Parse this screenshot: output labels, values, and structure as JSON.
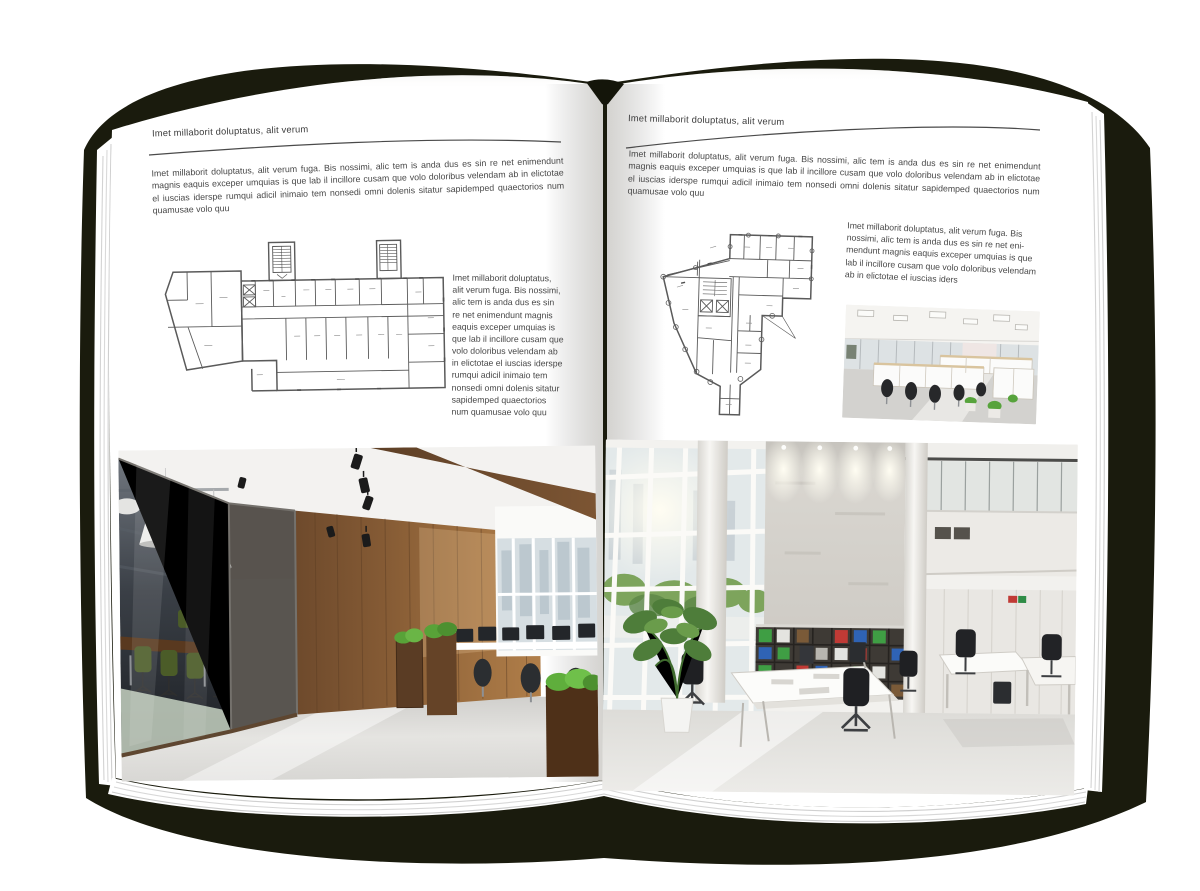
{
  "canvas": {
    "background": "#ffffff",
    "backdrop_color": "#1a1b0d",
    "page_color": "#ffffff",
    "rule_color": "#4a4a4a"
  },
  "left_page": {
    "header": "Imet millaborit doluptatus, alit verum",
    "intro": "Imet millaborit doluptatus, alit verum fuga. Bis nossimi, alic tem is anda dus es sin re net enimendunt magnis eaquis exceper umquias is que lab il incillore cusam que volo doloribus velendam ab in elictotae el iuscias iderspe rumqui adicil inimaio tem nonsedi omni dolenis sitatur sapidemped quaectorios num quamusae volo quu",
    "side_text": "Imet millaborit doluptatus, alit verum fuga. Bis nossimi, alic tem is anda dus es sin re net enimendunt magnis eaquis exceper umquias is que lab il incillore cusam que volo doloribus velendam ab in elictotae el iuscias iderspe rumqui adicil inimaio tem nonsedi omni dolenis sitatur sapidemped quaectorios num quamusae volo quu"
  },
  "right_page": {
    "header": "Imet millaborit doluptatus, alit verum",
    "intro": "Imet millaborit doluptatus, alit verum fuga. Bis nossimi, alic tem is anda dus es sin re net enimendunt magnis eaquis exceper umquias is que lab il incillore cusam que volo doloribus velendam ab in elictotae el iuscias iderspe rumqui adicil inimaio tem nonsedi omni dolenis sitatur sapidemped quaectorios num quamusae volo quu",
    "side_text": "Imet millaborit doluptatus, alit verum fuga. Bis nossimi, alic tem is anda dus es sin re net eni­mendunt magnis eaquis exceper umquias is que lab il incillore cusam que volo doloribus velendam ab in elictotae el iuscias iders"
  }
}
